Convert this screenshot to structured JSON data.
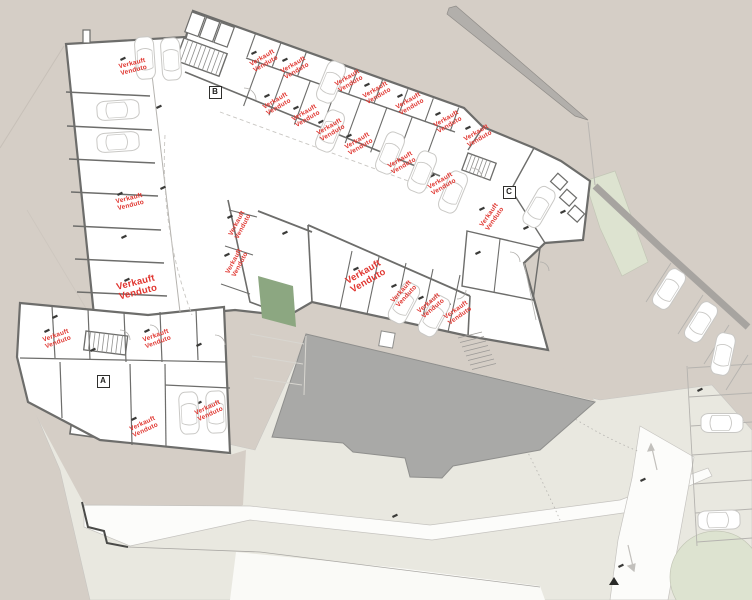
{
  "plan": {
    "sold_label": {
      "line1": "Verkauft",
      "line2": "Venduto"
    },
    "stairs": [
      {
        "label": "A",
        "x": 103,
        "y": 381
      },
      {
        "label": "B",
        "x": 215,
        "y": 92
      },
      {
        "label": "C",
        "x": 509,
        "y": 192
      }
    ],
    "sold_positions": [
      {
        "x": 133,
        "y": 67,
        "rot": -14,
        "size": "normal"
      },
      {
        "x": 264,
        "y": 61,
        "rot": -30,
        "size": "normal"
      },
      {
        "x": 295,
        "y": 68,
        "rot": -30,
        "size": "normal"
      },
      {
        "x": 349,
        "y": 81,
        "rot": -30,
        "size": "normal"
      },
      {
        "x": 377,
        "y": 93,
        "rot": -30,
        "size": "normal"
      },
      {
        "x": 410,
        "y": 104,
        "rot": -30,
        "size": "normal"
      },
      {
        "x": 448,
        "y": 122,
        "rot": -30,
        "size": "normal"
      },
      {
        "x": 478,
        "y": 136,
        "rot": -30,
        "size": "normal"
      },
      {
        "x": 277,
        "y": 104,
        "rot": -30,
        "size": "normal"
      },
      {
        "x": 306,
        "y": 116,
        "rot": -30,
        "size": "normal"
      },
      {
        "x": 331,
        "y": 130,
        "rot": -30,
        "size": "normal"
      },
      {
        "x": 359,
        "y": 144,
        "rot": -30,
        "size": "normal"
      },
      {
        "x": 402,
        "y": 163,
        "rot": -30,
        "size": "normal"
      },
      {
        "x": 442,
        "y": 184,
        "rot": -30,
        "size": "normal"
      },
      {
        "x": 492,
        "y": 217,
        "rot": -55,
        "size": "normal"
      },
      {
        "x": 240,
        "y": 225,
        "rot": -62,
        "size": "normal"
      },
      {
        "x": 237,
        "y": 263,
        "rot": -62,
        "size": "normal"
      },
      {
        "x": 130,
        "y": 202,
        "rot": -14,
        "size": "normal"
      },
      {
        "x": 137,
        "y": 288,
        "rot": -14,
        "size": "large"
      },
      {
        "x": 366,
        "y": 277,
        "rot": -30,
        "size": "large"
      },
      {
        "x": 404,
        "y": 294,
        "rot": -48,
        "size": "normal"
      },
      {
        "x": 431,
        "y": 306,
        "rot": -40,
        "size": "normal"
      },
      {
        "x": 458,
        "y": 313,
        "rot": -35,
        "size": "normal"
      },
      {
        "x": 57,
        "y": 339,
        "rot": -20,
        "size": "normal"
      },
      {
        "x": 157,
        "y": 339,
        "rot": -20,
        "size": "normal"
      },
      {
        "x": 144,
        "y": 427,
        "rot": -25,
        "size": "normal"
      },
      {
        "x": 209,
        "y": 411,
        "rot": -25,
        "size": "normal"
      }
    ],
    "cars": [
      {
        "x": 145,
        "y": 58,
        "rot": -4
      },
      {
        "x": 171,
        "y": 59,
        "rot": -4
      },
      {
        "x": 118,
        "y": 110,
        "rot": 86
      },
      {
        "x": 118,
        "y": 142,
        "rot": 86
      },
      {
        "x": 331,
        "y": 82,
        "rot": 22
      },
      {
        "x": 330,
        "y": 131,
        "rot": 22
      },
      {
        "x": 390,
        "y": 153,
        "rot": 22
      },
      {
        "x": 422,
        "y": 172,
        "rot": 22
      },
      {
        "x": 453,
        "y": 192,
        "rot": 22
      },
      {
        "x": 404,
        "y": 303,
        "rot": 28
      },
      {
        "x": 434,
        "y": 316,
        "rot": 28
      },
      {
        "x": 539,
        "y": 207,
        "rot": 30
      },
      {
        "x": 189,
        "y": 413,
        "rot": -3
      },
      {
        "x": 216,
        "y": 412,
        "rot": -3
      },
      {
        "x": 669,
        "y": 289,
        "rot": 32
      },
      {
        "x": 701,
        "y": 322,
        "rot": 32
      },
      {
        "x": 723,
        "y": 354,
        "rot": 12
      },
      {
        "x": 722,
        "y": 423,
        "rot": 90
      },
      {
        "x": 719,
        "y": 520,
        "rot": 88
      }
    ],
    "colors": {
      "background": "#d5cec6",
      "terrain_light": "#e9e8e0",
      "road_white": "#fcfcfa",
      "building": "#ffffff",
      "wall": "#6d6d6b",
      "existing_building": "#a9a9a7",
      "road_edge_dark": "#a7a4a0",
      "grass_dark": "#8ca781",
      "grass_light": "#dde3d0",
      "sold_red": "#e0352f",
      "car_outline": "#c9c8c5"
    }
  }
}
